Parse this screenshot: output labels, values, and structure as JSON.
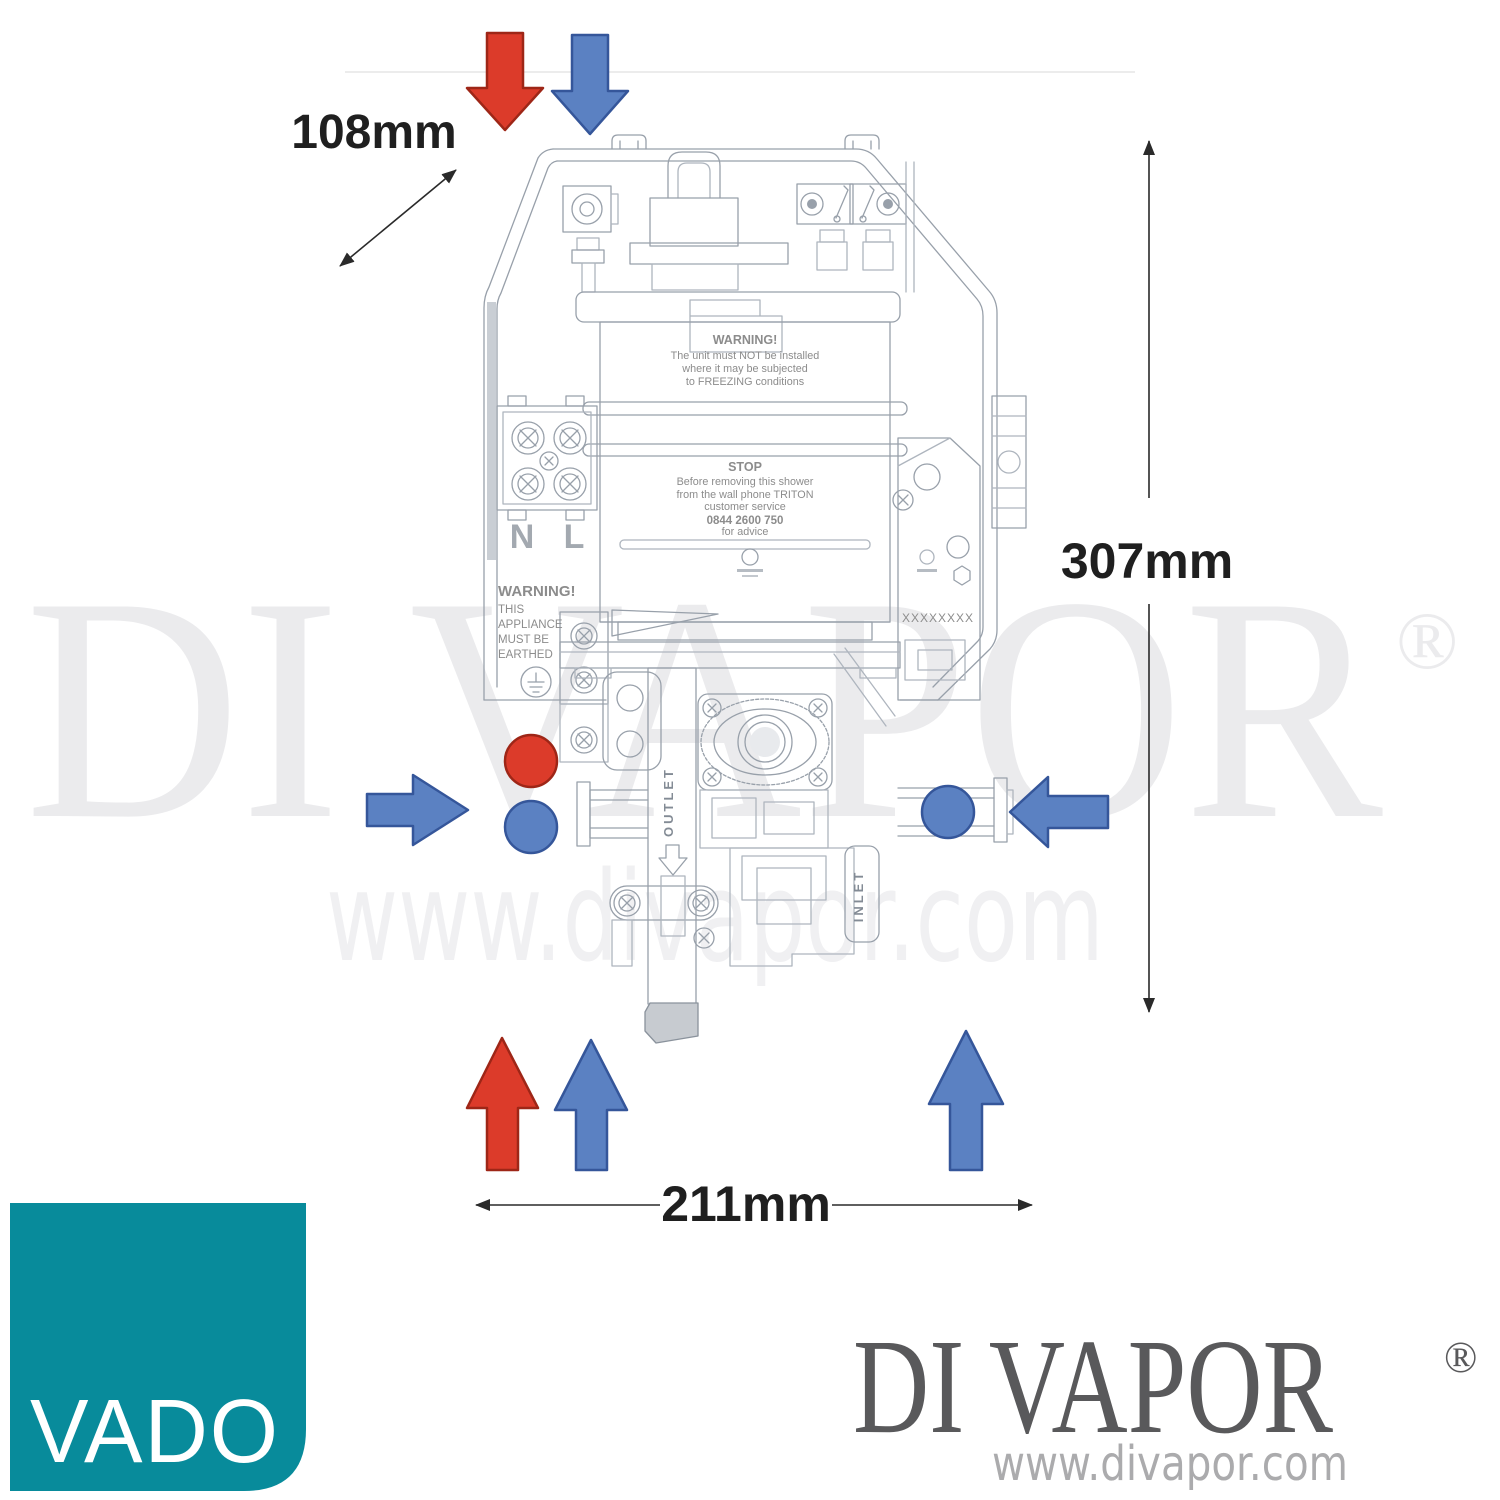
{
  "dimensions": {
    "depth_label": "108mm",
    "height_label": "307mm",
    "width_label": "211mm"
  },
  "unit_labels": {
    "freeze_warning": {
      "title": "WARNING!",
      "lines": [
        "The unit must NOT be installed",
        "where it may be subjected",
        "to FREEZING conditions"
      ]
    },
    "stop_notice": {
      "title": "STOP",
      "lines": [
        "Before removing this shower",
        "from the wall phone TRITON",
        "customer service",
        "0844 2600 750",
        "for advice"
      ]
    },
    "terminal_neutral": "N",
    "terminal_live": "L",
    "earth_warning": {
      "lines": [
        "WARNING!",
        "THIS",
        "APPLIANCE",
        "MUST BE",
        "EARTHED"
      ]
    },
    "outlet": "OUTLET",
    "inlet": "INLET",
    "serial_placeholder": "XXXXXXXX"
  },
  "flow_colors": {
    "hot": "#dc3b2a",
    "cold": "#5b81c2"
  },
  "watermark": {
    "brand": "DI VAPOR",
    "registered": "®",
    "url": "www.divapor.com",
    "color": "#ebebed"
  },
  "footer": {
    "vado_logo": {
      "label": "VADO",
      "background": "#088b9b"
    },
    "divapor_logo": {
      "brand": "DI VAPOR",
      "registered": "®",
      "url": "www.divapor.com"
    }
  }
}
